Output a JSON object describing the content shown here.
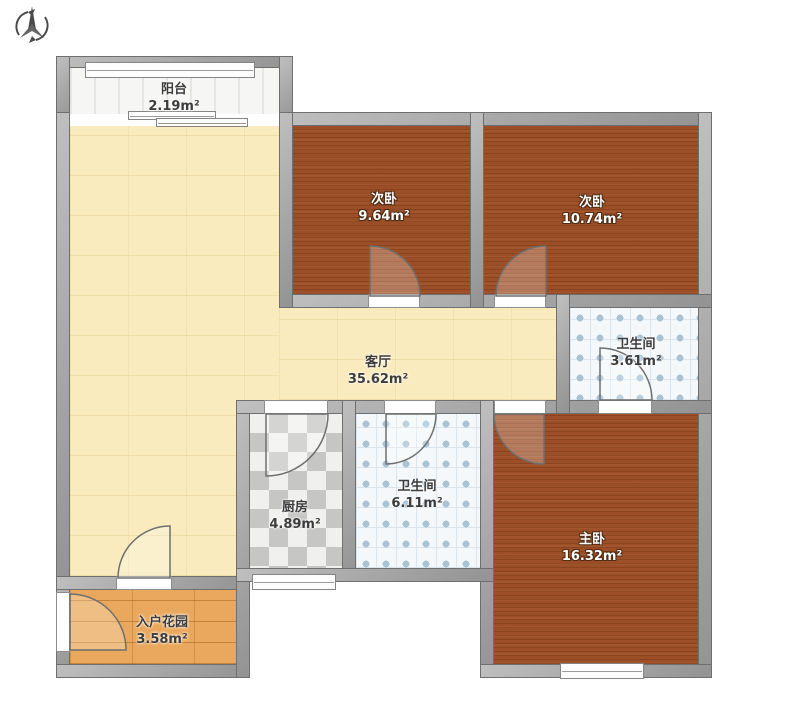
{
  "plan_title": "apartment-floor-plan",
  "compass": {
    "icon": "north-compass-icon"
  },
  "rooms": [
    {
      "id": "balcony",
      "name": "阳台",
      "area": "2.19m²"
    },
    {
      "id": "bedroom-second-left",
      "name": "次卧",
      "area": "9.64m²"
    },
    {
      "id": "bedroom-second-right",
      "name": "次卧",
      "area": "10.74m²"
    },
    {
      "id": "living-room",
      "name": "客厅",
      "area": "35.62m²"
    },
    {
      "id": "bathroom-small",
      "name": "卫生间",
      "area": "3.61m²"
    },
    {
      "id": "kitchen",
      "name": "厨房",
      "area": "4.89m²"
    },
    {
      "id": "bathroom-large",
      "name": "卫生间",
      "area": "6.11m²"
    },
    {
      "id": "master-bedroom",
      "name": "主卧",
      "area": "16.32m²"
    },
    {
      "id": "entrance-garden",
      "name": "入户花园",
      "area": "3.58m²"
    }
  ],
  "colors": {
    "wall": "#a6a6a6",
    "bedroom_floor": "#9c4e26",
    "living_floor": "#f9ebbd",
    "kitchen_tile_dark": "#c6c6c4",
    "bath_tile_dot": "#a9c2d4",
    "garden_floor": "#e9a85d",
    "label_light": "#ffffff",
    "label_dark": "#3c3c3c"
  }
}
